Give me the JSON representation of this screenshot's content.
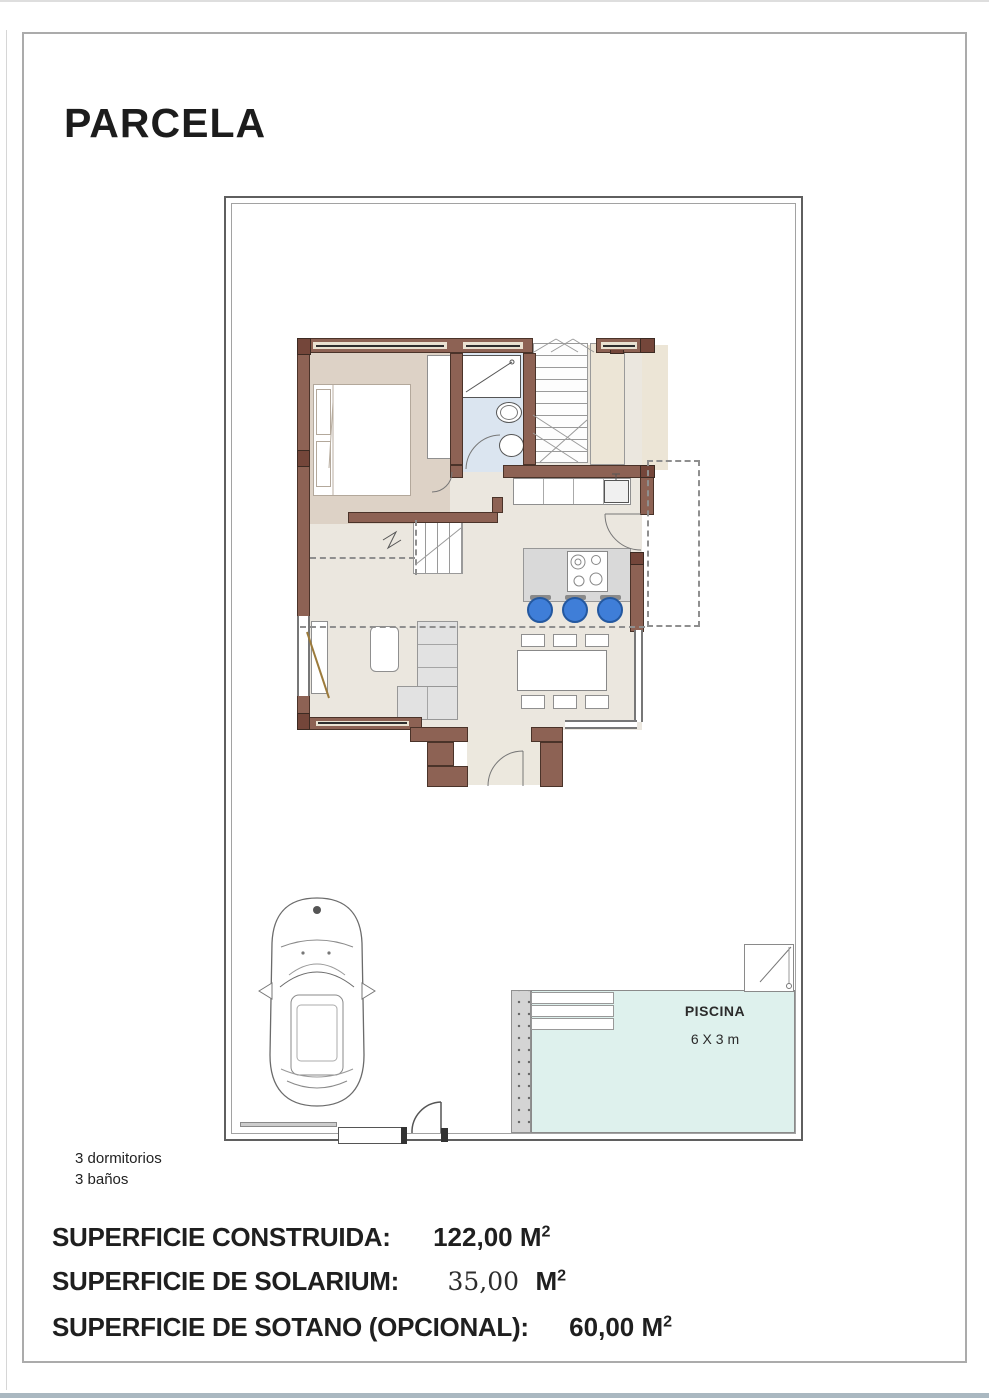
{
  "page": {
    "title": "PARCELA"
  },
  "pool": {
    "label": "PISCINA",
    "size_label": "6 X 3 m"
  },
  "features": {
    "bedrooms": "3 dormitorios",
    "bathrooms": "3 baños"
  },
  "areas": {
    "construida": {
      "label": "SUPERFICIE CONSTRUIDA:",
      "value": "122,00",
      "unit": "M",
      "exp": "2"
    },
    "solarium": {
      "label": "SUPERFICIE DE SOLARIUM:",
      "value": "35,00",
      "unit": "M",
      "exp": "2"
    },
    "sotano": {
      "label": "SUPERFICIE DE SOTANO (OPCIONAL):",
      "value": "60,00",
      "unit": "M",
      "exp": "2"
    }
  },
  "colors": {
    "wall": "#8d6254",
    "wall_dark": "#74463a",
    "bedroom_floor": "#ddd2c6",
    "living_floor": "#ebe7df",
    "bathroom_floor": "#dbe5f0",
    "terrace_shade": "#ece5d6",
    "pool_water": "#def1ed",
    "stool_blue": "#3f7ed8",
    "window_lintel": "#e9e1d1"
  }
}
